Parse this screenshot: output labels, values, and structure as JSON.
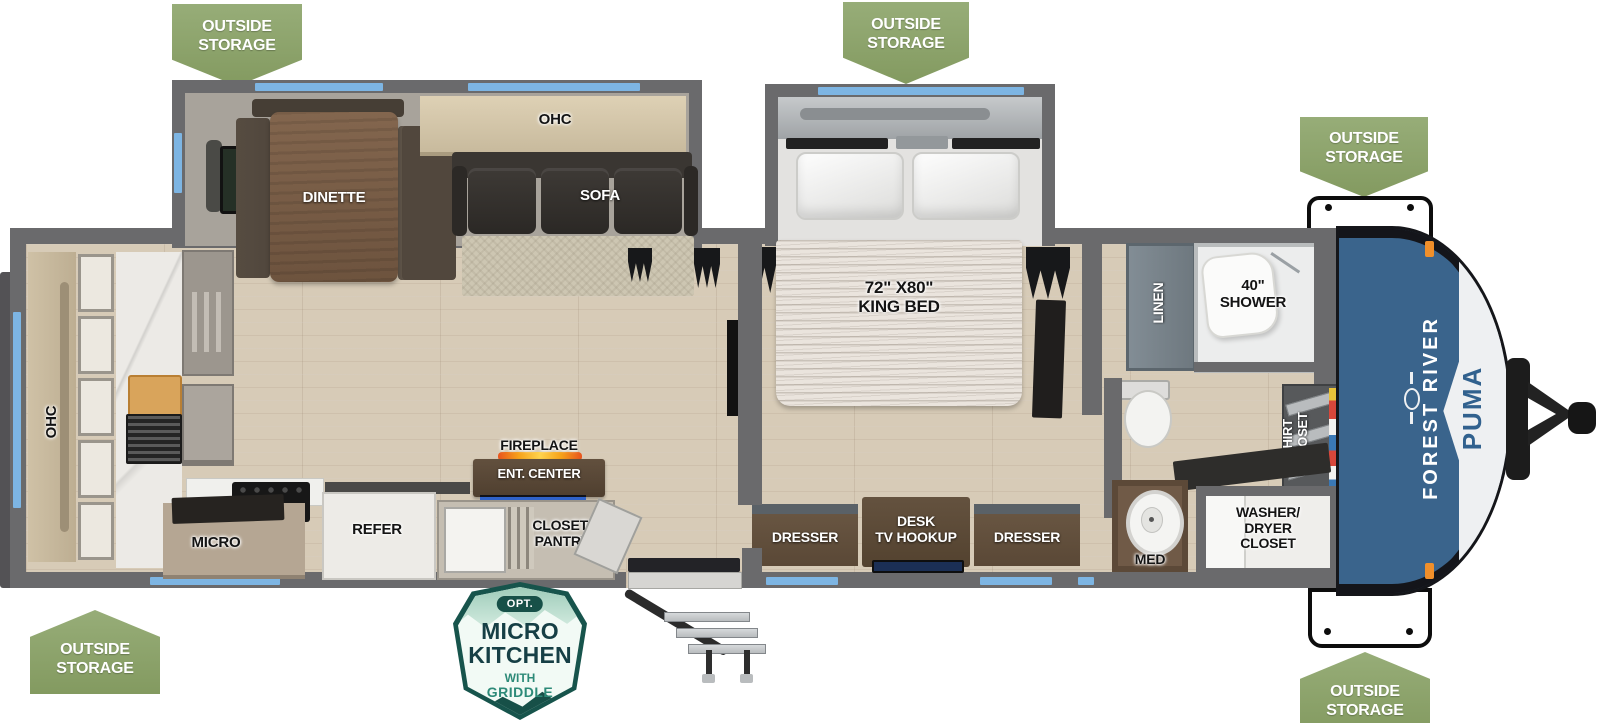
{
  "colors": {
    "banner_green": "#8ca46d",
    "window_blue": "#7db5e3",
    "wall_gray": "#6a6a6c",
    "front_cap_blue": "#3a648c",
    "badge_teal": "#17544c"
  },
  "banner": {
    "line1": "OUTSIDE",
    "line2": "STORAGE"
  },
  "labels": {
    "ohc_rear": "OHC",
    "micro": "MICRO",
    "refer": "REFER",
    "fireplace": "FIREPLACE",
    "ent_center": "ENT. CENTER",
    "closet_pantry_1": "CLOSET/",
    "closet_pantry_2": "PANTRY",
    "dinette": "DINETTE",
    "sofa": "SOFA",
    "ohc_sofa": "OHC",
    "bed_size": "72\" X80\"",
    "bed_name": "KING BED",
    "dresser_left": "DRESSER",
    "desk_1": "DESK",
    "desk_2": "TV HOOKUP",
    "dresser_right": "DRESSER",
    "linen": "LINEN",
    "shower_size": "40\"",
    "shower": "SHOWER",
    "shirt_1": "SHIRT",
    "shirt_2": "CLOSET",
    "med": "MED",
    "washer_dryer_1": "WASHER/",
    "washer_dryer_2": "DRYER",
    "washer_dryer_3": "CLOSET"
  },
  "badge": {
    "opt": "OPT.",
    "line1": "MICRO",
    "line2": "KITCHEN",
    "line3": "WITH",
    "line4": "GRIDDLE"
  },
  "branding": {
    "make": "FOREST RIVER",
    "model": "PUMA"
  }
}
